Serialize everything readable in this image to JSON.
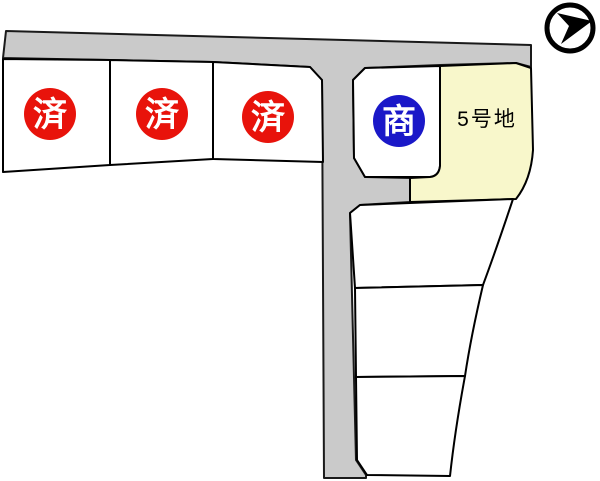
{
  "canvas": {
    "width": 600,
    "height": 481
  },
  "colors": {
    "background": "#ffffff",
    "road_fill": "#cacaca",
    "lot_fill": "#ffffff",
    "highlight_fill": "#f8f7cb",
    "outline": "#000000",
    "sold_badge_fill": "#e8130b",
    "negotiating_badge_fill": "#1a18c8",
    "badge_text": "#ffffff",
    "label_text": "#000000",
    "compass_color": "#000000"
  },
  "lots": [
    {
      "id": "lot-1",
      "badge": "済"
    },
    {
      "id": "lot-2",
      "badge": "済"
    },
    {
      "id": "lot-3",
      "badge": "済"
    },
    {
      "id": "lot-4",
      "badge": "商"
    },
    {
      "id": "lot-5",
      "label": "5号地"
    },
    {
      "id": "lot-6"
    },
    {
      "id": "lot-7"
    },
    {
      "id": "lot-8"
    }
  ],
  "compass": {
    "icon": "north-arrow"
  }
}
